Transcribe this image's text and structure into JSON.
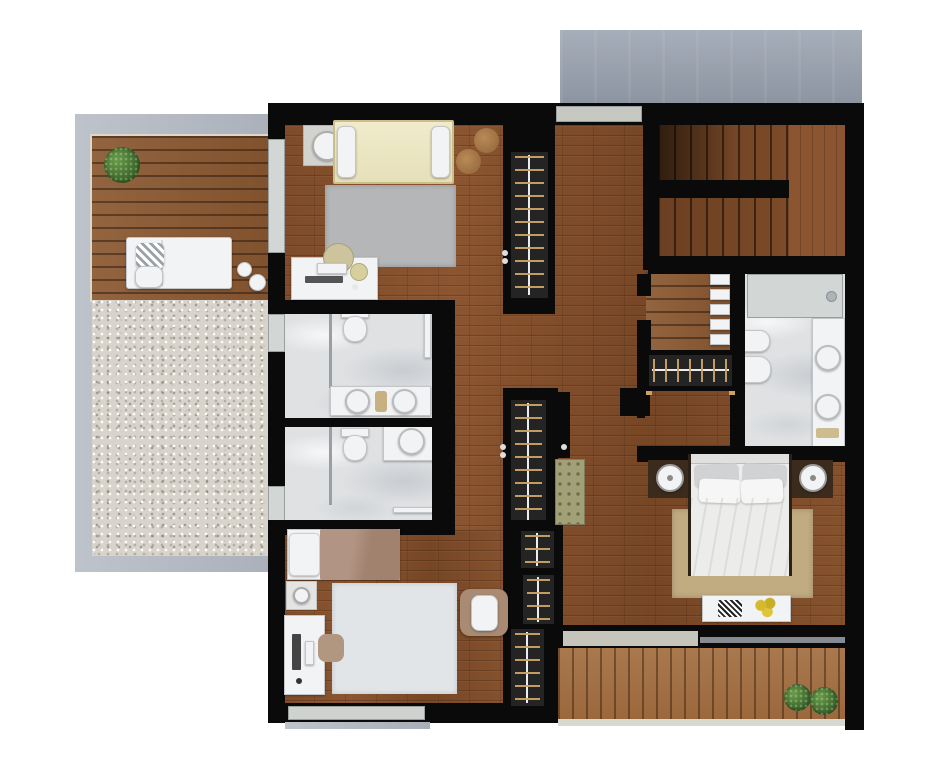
{
  "scene": {
    "kind": "architectural-floor-plan-render",
    "view": "top-down",
    "level": "upper-floor",
    "visible_text": "none"
  },
  "palette": {
    "background": "#ffffff",
    "wall": "#0a0a0a",
    "interior_wood": "#7e4c2a",
    "terrace_deck": "#8a5831",
    "balcony_deck": "#a26d3e",
    "stair_wood": "#6f4223",
    "marble": "#dfe1e3",
    "gravel": "#d8d4cb",
    "concrete_border": "#b3b9c3",
    "roof_slab": "#9aa3b1",
    "glass": "#d2d6d5",
    "white_furniture": "#f2f3f4",
    "wardrobe_interior": "#242424",
    "hanger_gold": "#cba264",
    "rug_gray": "#b4b6b8",
    "rug_light": "#e2e5e7",
    "rug_tan": "#c1ab81",
    "bed1_duvet_cream": "#ebe6c2",
    "bed2_blanket": "#a78a79",
    "master_duvet": "#ececea",
    "bench_olive": "#a2a077",
    "plant_green": "#4b7a33",
    "flowers_yellow": "#d6b92e"
  },
  "counts": {
    "bedrooms": 3,
    "bathrooms": 3,
    "wardrobe_units": 6,
    "outdoor_areas": 3,
    "plants": 3,
    "staircases": 1
  },
  "outdoor": {
    "roof_slab": {
      "position": "top-right",
      "material": "concrete"
    },
    "terrace_left": {
      "materials": [
        "wood-deck",
        "gravel",
        "concrete-border"
      ],
      "furniture": [
        "potted-plant",
        "daybed-with-pillows",
        "side-table",
        "side-table"
      ]
    },
    "balcony_bottom_right": {
      "materials": [
        "wood-deck"
      ],
      "furniture": [
        "potted-plant",
        "potted-plant"
      ]
    }
  },
  "rooms": [
    {
      "id": "bedroom-1",
      "position": "top-left",
      "floor": "wood",
      "furniture": [
        "double-bed-cream",
        "pillow",
        "pillow",
        "nightstand-with-lamp",
        "pouf",
        "pouf",
        "gray-rug",
        "desk-with-computer",
        "desk-chair",
        "wardrobe"
      ]
    },
    {
      "id": "bathroom-1",
      "position": "mid-left",
      "floor": "marble",
      "fixtures": [
        "toilet",
        "double-sink-counter",
        "glass-shower-partition",
        "window",
        "door"
      ]
    },
    {
      "id": "bathroom-2",
      "position": "mid-left-lower",
      "floor": "marble",
      "fixtures": [
        "toilet",
        "single-sink-counter",
        "glass-shower-partition",
        "window",
        "door"
      ]
    },
    {
      "id": "bedroom-2",
      "position": "bottom-left",
      "floor": "wood",
      "furniture": [
        "single-bed-brown-blanket",
        "pillow",
        "nightstand-with-lamp",
        "desk-with-monitor",
        "desk-chair",
        "light-rug",
        "armchair",
        "window"
      ]
    },
    {
      "id": "hallway",
      "position": "center",
      "floor": "wood",
      "furniture": [
        "wardrobe-tall",
        "wardrobe-small",
        "wardrobe-small",
        "wardrobe-small",
        "tufted-bench-olive",
        "window-top",
        "door-leaf",
        "door-leaf"
      ]
    },
    {
      "id": "staircase",
      "position": "top-right",
      "features": [
        "upper-flight",
        "lower-flight",
        "mid-wall",
        "landing"
      ]
    },
    {
      "id": "linen-shelf",
      "position": "right-of-hallway",
      "features": [
        "wood-shelf",
        "towel-stack-x5"
      ]
    },
    {
      "id": "master-bathroom",
      "position": "right",
      "floor": "marble",
      "fixtures": [
        "glass-shower",
        "bidet",
        "toilet",
        "double-sink-counter",
        "bath-mat"
      ]
    },
    {
      "id": "master-bedroom",
      "position": "bottom-right",
      "floor": "wood",
      "furniture": [
        "double-bed-white",
        "pillow-gray",
        "pillow-gray",
        "pillow-white",
        "pillow-white",
        "speaker-nightstand-left",
        "speaker-nightstand-right",
        "tan-rug",
        "foot-bench-with-decor",
        "flowers",
        "clothes-rack"
      ]
    }
  ]
}
